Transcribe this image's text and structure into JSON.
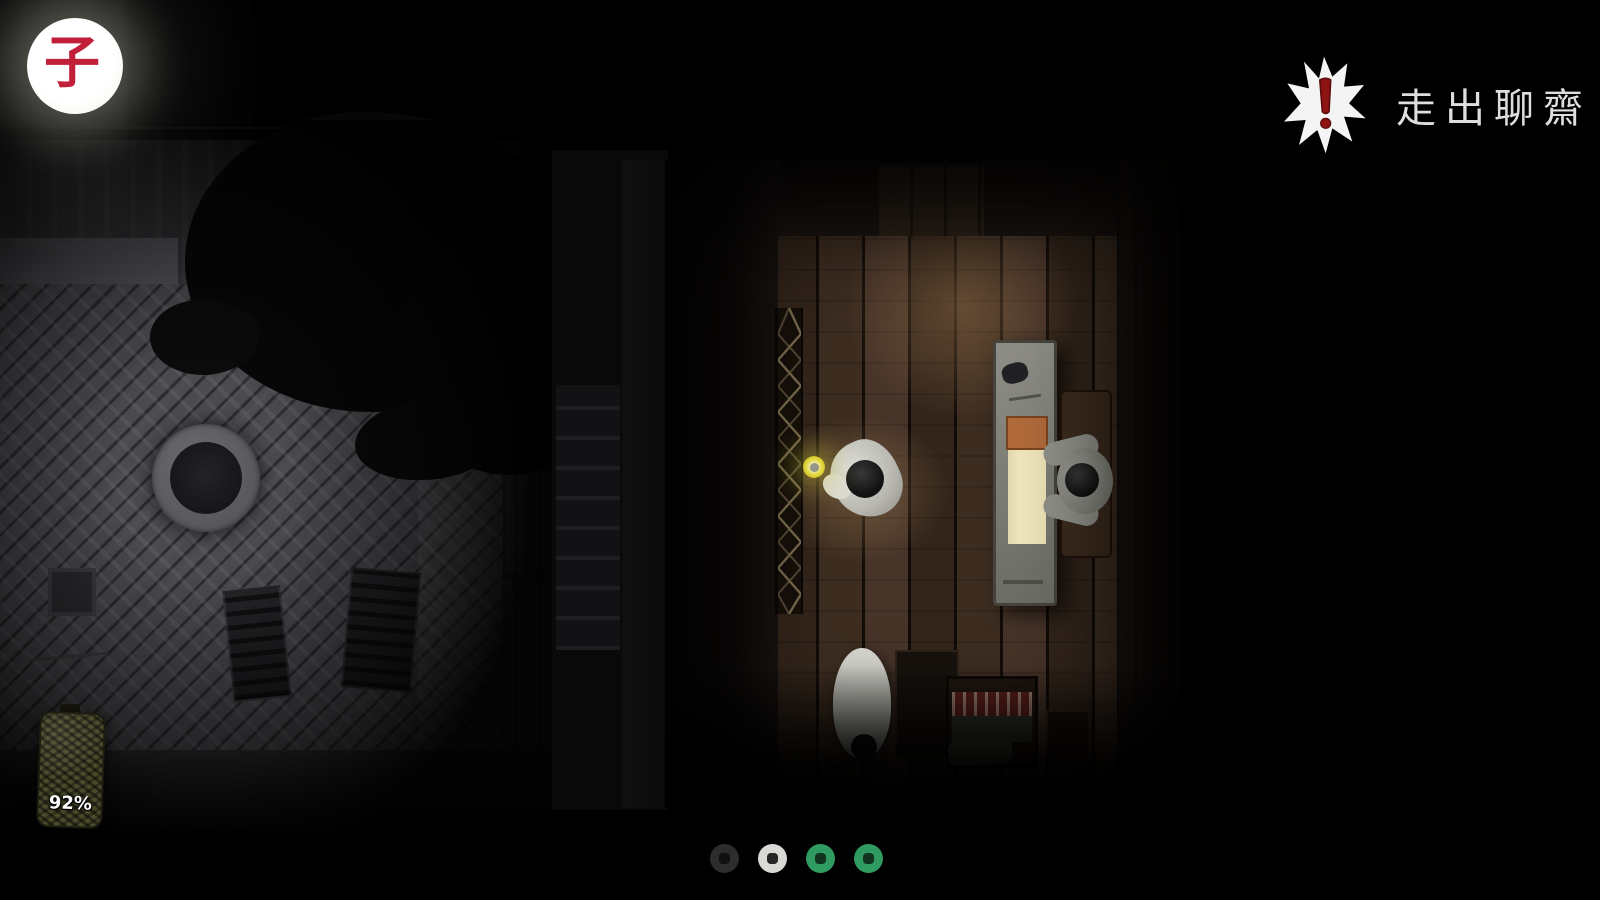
{
  "hud": {
    "time_indicator": {
      "character": "子",
      "character_color": "#c21f3a",
      "shape": "full-moon"
    },
    "title": {
      "text": "走出聊齋",
      "icon": "alert-star-icon",
      "icon_color": "#f4f4f4",
      "exclamation_color": "#8e1414"
    },
    "battery_item": {
      "percent": "92%",
      "body_color": "#4b4b2c"
    }
  },
  "page_indicator": {
    "dots": [
      {
        "index": 1,
        "state": "inactive",
        "color": "#2d2d2d",
        "hole_color": "#101010"
      },
      {
        "index": 2,
        "state": "current",
        "color": "#d9d9d5",
        "hole_color": "#262626"
      },
      {
        "index": 3,
        "state": "coin",
        "color": "#2f9b60",
        "hole_color": "#11331f"
      },
      {
        "index": 4,
        "state": "coin",
        "color": "#2f9b60",
        "hole_color": "#11331f"
      }
    ]
  },
  "scene": {
    "candle_glow_color": "#e8dd3a",
    "scroll_paper_color": "#f1e7bd",
    "scroll_band_color": "#b26b3b",
    "bed_pattern_color": "#5f211d"
  }
}
